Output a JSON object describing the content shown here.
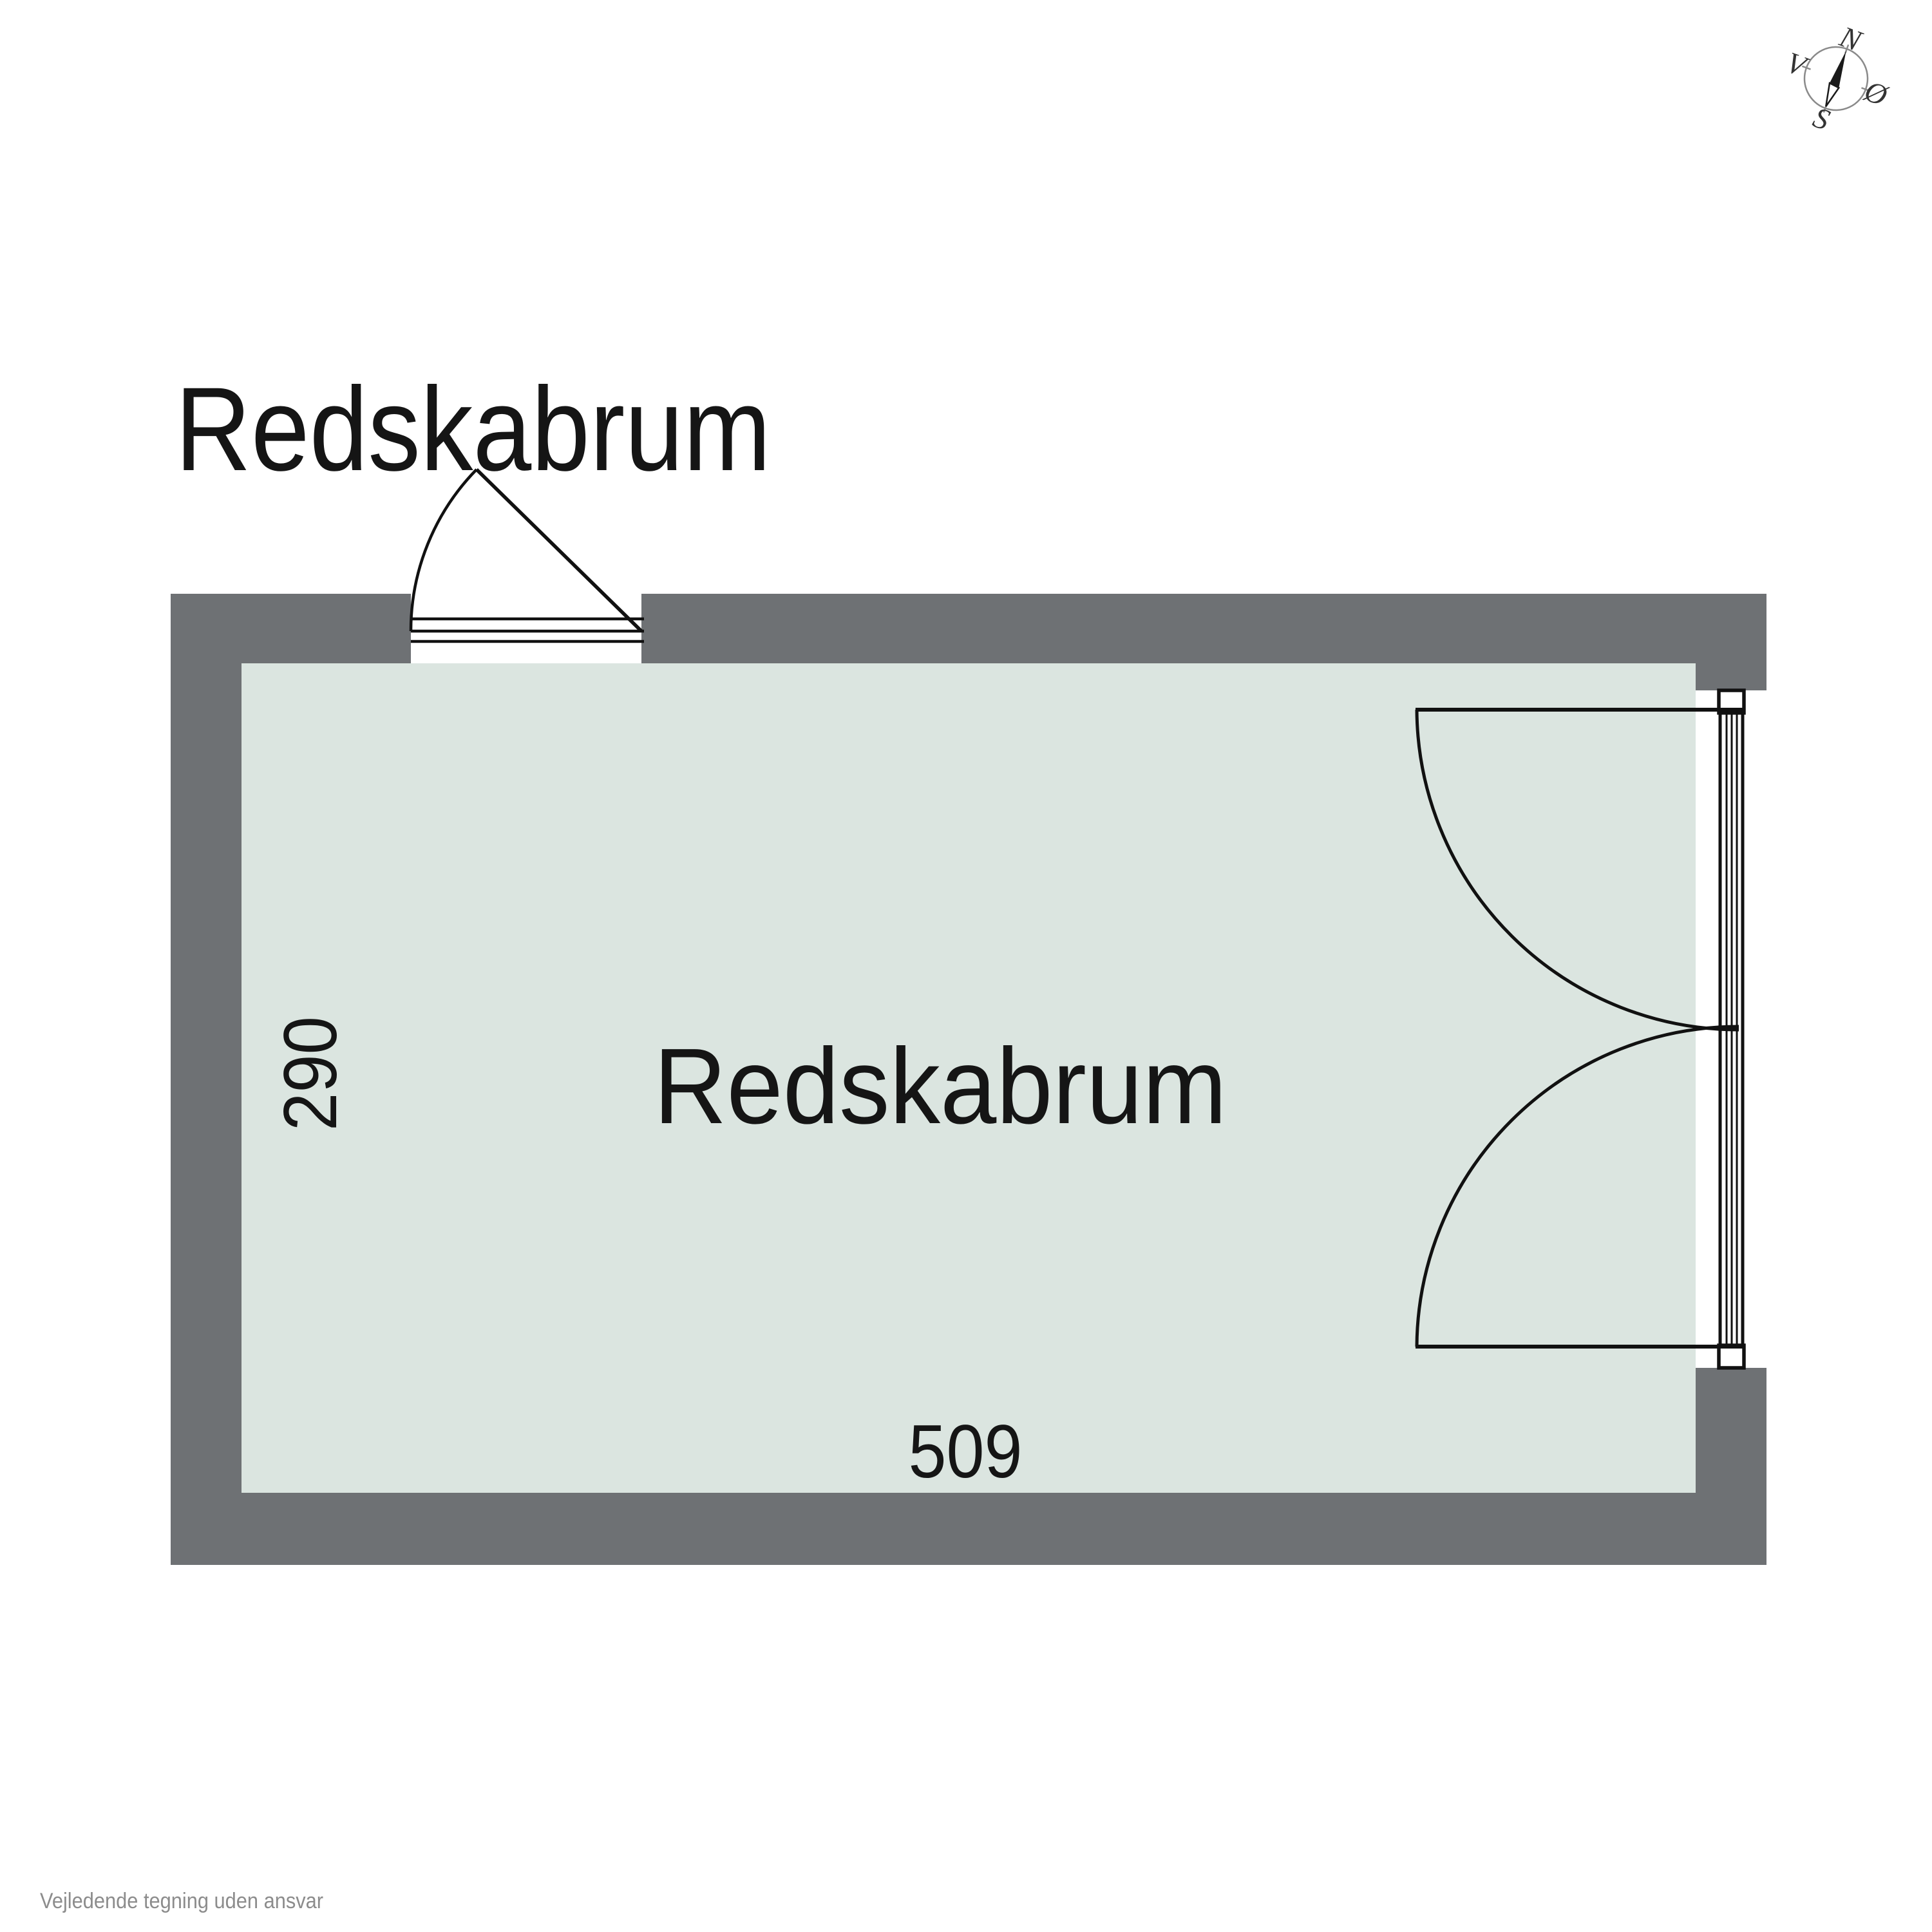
{
  "page": {
    "background_color": "#ffffff"
  },
  "plan_title": {
    "text": "Redskabrum"
  },
  "room": {
    "name": "Redskabrum",
    "width_label": "509",
    "depth_label": "290"
  },
  "compass": {
    "labels": {
      "north": "N",
      "east": "Ø",
      "south": "S",
      "west": "V"
    }
  },
  "footer": {
    "disclaimer": "Vejledende tegning uden ansvar"
  },
  "colors": {
    "wall": "#6e7174",
    "floor": "#dbe5e0",
    "outline": "#111111",
    "label_text": "#151515",
    "compass_ring": "#8a8a8a",
    "compass_needle": "#1a1a1a",
    "compass_letters": "#333333",
    "footer_text": "#8c8c8c"
  }
}
